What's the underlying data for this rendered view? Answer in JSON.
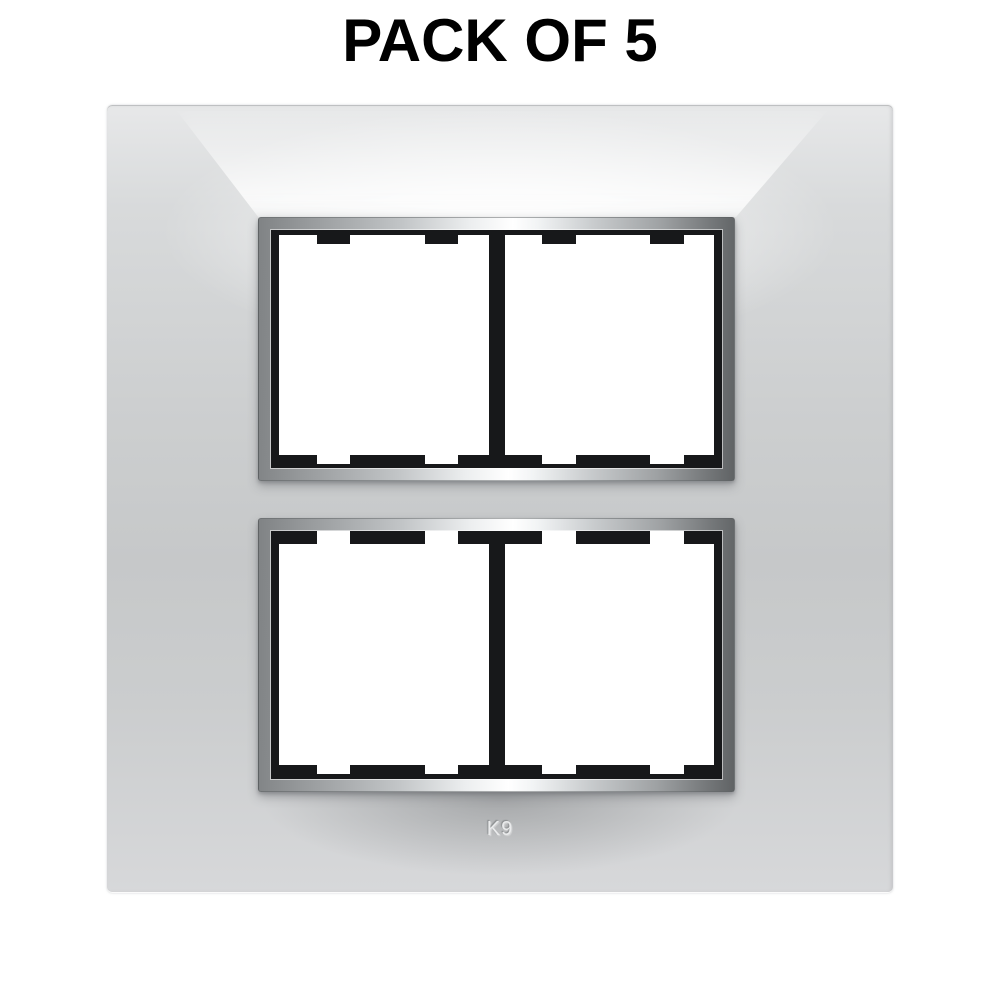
{
  "title": "PACK OF 5",
  "product": {
    "name": "modular-switch-cover-plate",
    "brand_label": "K9",
    "pack_quantity": 5,
    "apertures": [
      {
        "position": "top",
        "module_windows": 2
      },
      {
        "position": "bottom",
        "module_windows": 2
      }
    ]
  },
  "colors": {
    "page_bg": "#ffffff",
    "title_text": "#000000",
    "plate_base": "#cdcfd0",
    "plate_highlight": "#ffffff",
    "plate_shadow": "#a9abad",
    "chrome_bright": "#ffffff",
    "chrome_dark": "#606365",
    "frame_black": "#17181a",
    "module_white": "#ffffff",
    "brand_text": "#eaebec"
  }
}
